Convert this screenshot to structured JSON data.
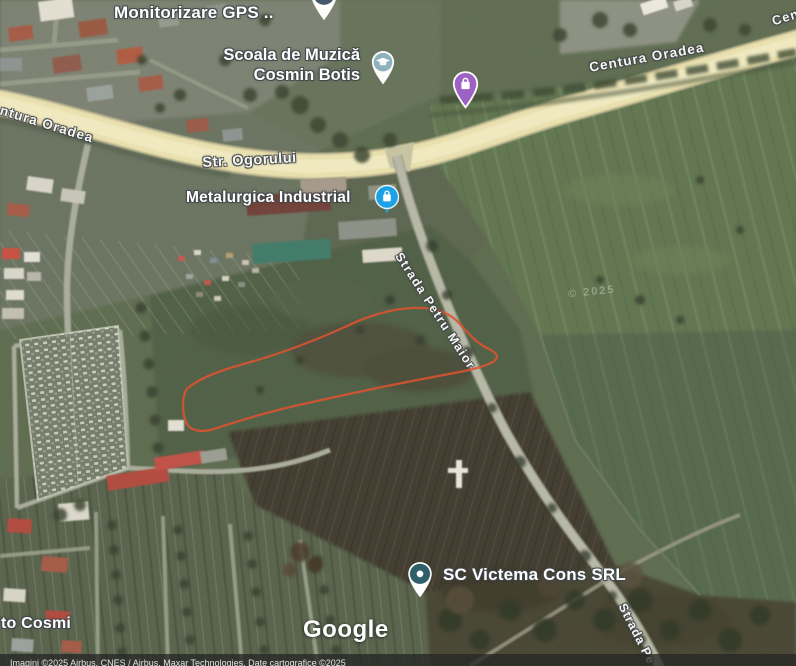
{
  "map_type": "satellite",
  "labels": {
    "monitorizare_gps": "Monitorizare GPS ..",
    "scoala_line1": "Scoala de Muzică",
    "scoala_line2": "Cosmin Botis",
    "centura_oradea_left": "Centura Oradea",
    "centura_oradea_mid": "Centura Oradea",
    "centura_oradea_corner": "Centura Oradea",
    "str_ogorului": "Str. Ogorului",
    "metalurgica_industrial": "Metalurgica Industrial",
    "strada_petru_maior": "Strada Petru Maior",
    "strada_petru_maior_bottom": "Strada Pe",
    "sc_victema": "SC Victema Cons SRL",
    "to_cosmi": "to Cosmi",
    "imagery_watermark": "© 2025"
  },
  "watermark": {
    "google_logo": "Google"
  },
  "attribution": {
    "text": "Imagini ©2025 Airbus, CNES / Airbus, Maxar Technologies, Date cartografice ©2025"
  },
  "pins": [
    {
      "id": "poi-pin-top",
      "icon": "dot-icon",
      "color": "#44596a"
    },
    {
      "id": "school-pin",
      "icon": "graduation-cap-icon",
      "color": "#8fb0bd"
    },
    {
      "id": "shopping-pin",
      "icon": "shopping-bag-icon",
      "color": "#9c62c4"
    },
    {
      "id": "metalurgica-pin",
      "icon": "shopping-bag-icon",
      "color": "#1aa1e6"
    },
    {
      "id": "victema-pin",
      "icon": "dot-icon",
      "color": "#2f5f68"
    }
  ],
  "colors": {
    "road-yellow": "#ebe1af",
    "road-gray": "#b7b8a7",
    "plot-outline": "#dd4f2b",
    "pin-purple": "#9c62c4",
    "pin-blue": "#1aa1e6",
    "pin-school-fill": "#8fb0bd",
    "pin-victema-fill": "#2f5f68",
    "label-text": "#ffffff"
  }
}
